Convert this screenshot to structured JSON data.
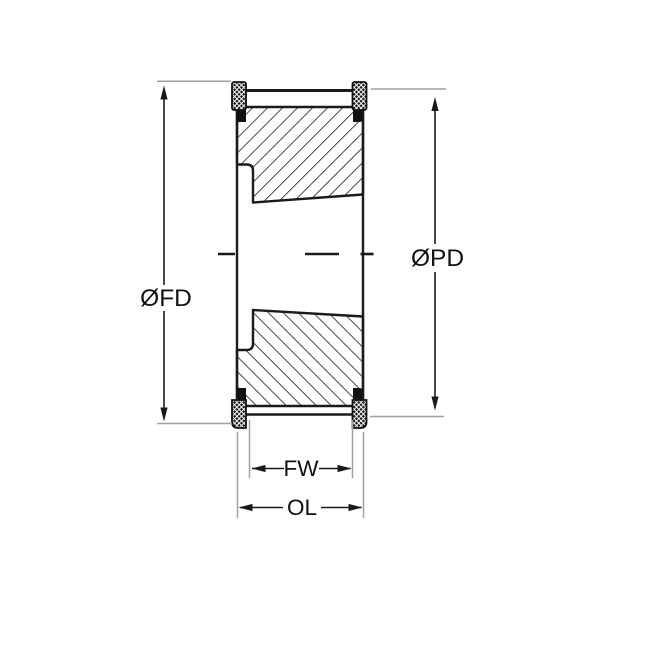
{
  "drawing": {
    "labels": {
      "flange_diameter": "ØFD",
      "pitch_diameter": "ØPD",
      "face_width": "FW",
      "overall_length": "OL"
    },
    "colors": {
      "ink": "#1a1a1a",
      "extension_line": "#a0a0a0",
      "background": "#ffffff"
    }
  }
}
